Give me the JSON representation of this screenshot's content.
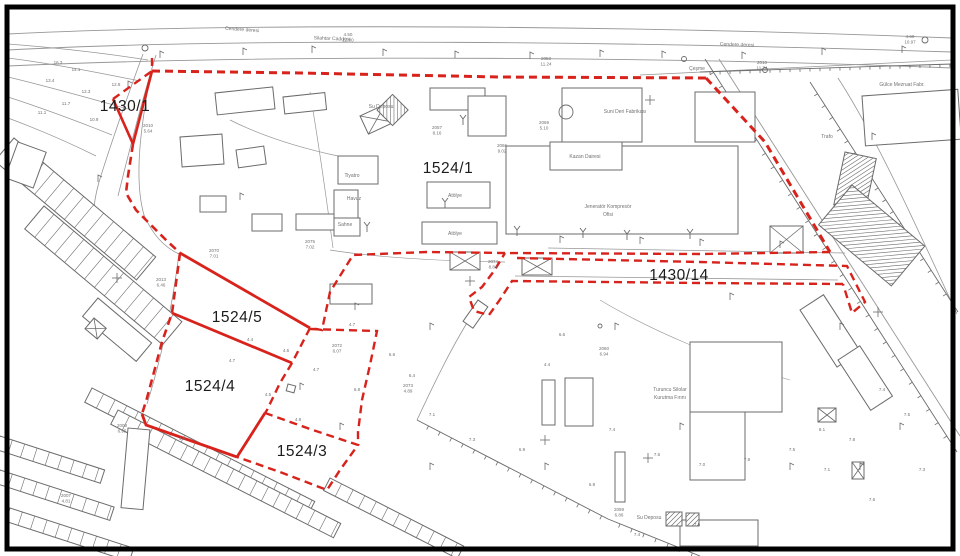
{
  "meta": {
    "type": "cadastral-survey-map",
    "width": 960,
    "height": 556
  },
  "colors": {
    "background": "#ffffff",
    "frame": "#000000",
    "ink": "#6b6b6b",
    "ink_light": "#979797",
    "red": "#d8231c",
    "text_dark": "#1c1c1c",
    "text_gray": "#707070"
  },
  "parcel_labels": [
    {
      "id": "1430/1",
      "x": 125,
      "y": 111
    },
    {
      "id": "1524/1",
      "x": 448,
      "y": 173
    },
    {
      "id": "1430/14",
      "x": 679,
      "y": 280
    },
    {
      "id": "1524/5",
      "x": 237,
      "y": 322
    },
    {
      "id": "1524/4",
      "x": 210,
      "y": 391
    },
    {
      "id": "1524/3",
      "x": 302,
      "y": 456
    }
  ],
  "street_labels": [
    {
      "text": "Cendere deresi",
      "x": 242,
      "y": 31,
      "rot": 4
    },
    {
      "text": "Silahtar Caddesi",
      "x": 332,
      "y": 40,
      "rot": 2
    },
    {
      "text": "Cendere deresi",
      "x": 737,
      "y": 46,
      "rot": 2
    },
    {
      "text": "Çeşme",
      "x": 697,
      "y": 70,
      "rot": 0
    }
  ],
  "facility_labels": [
    {
      "text": "Suni Deri Fabrikası",
      "x": 625,
      "y": 113
    },
    {
      "text": "Kazan Dairesi",
      "x": 585,
      "y": 158
    },
    {
      "text": "Jeneratör Kompresör",
      "x": 608,
      "y": 208
    },
    {
      "text": "Ofisi",
      "x": 608,
      "y": 216
    },
    {
      "text": "Tiyatro",
      "x": 352,
      "y": 177
    },
    {
      "text": "Havuz",
      "x": 354,
      "y": 200
    },
    {
      "text": "Sahne",
      "x": 345,
      "y": 226
    },
    {
      "text": "Atölye",
      "x": 455,
      "y": 197
    },
    {
      "text": "Atölye",
      "x": 455,
      "y": 235
    },
    {
      "text": "Su Deposu",
      "x": 381,
      "y": 108
    },
    {
      "text": "Gülce Mezruat Fabr.",
      "x": 902,
      "y": 86
    },
    {
      "text": "Trafo",
      "x": 827,
      "y": 138
    },
    {
      "text": "Turuncu Silolar",
      "x": 670,
      "y": 391
    },
    {
      "text": "Kurutma Fırını",
      "x": 670,
      "y": 399
    },
    {
      "text": "Su Deposu",
      "x": 649,
      "y": 519
    }
  ],
  "survey_points": [
    {
      "id": "2010",
      "elev": "5.64",
      "x": 148,
      "y": 127
    },
    {
      "id": "2053",
      "elev": "11.24",
      "x": 546,
      "y": 60
    },
    {
      "id": "2010",
      "elev": "11.74",
      "x": 762,
      "y": 64
    },
    {
      "id": "4.50",
      "elev": "12.00",
      "x": 348,
      "y": 36
    },
    {
      "id": "4.60",
      "elev": "10.97",
      "x": 910,
      "y": 38
    },
    {
      "id": "2057",
      "elev": "8.16",
      "x": 437,
      "y": 129
    },
    {
      "id": "2069",
      "elev": "5.10",
      "x": 544,
      "y": 124
    },
    {
      "id": "2066",
      "elev": "9.02",
      "x": 502,
      "y": 147
    },
    {
      "id": "2074",
      "elev": "8.84",
      "x": 493,
      "y": 263
    },
    {
      "id": "2075",
      "elev": "7.02",
      "x": 310,
      "y": 243
    },
    {
      "id": "2070",
      "elev": "7.01",
      "x": 214,
      "y": 252
    },
    {
      "id": "2013",
      "elev": "6.46",
      "x": 161,
      "y": 281
    },
    {
      "id": "2072",
      "elev": "6.07",
      "x": 337,
      "y": 347
    },
    {
      "id": "2073",
      "elev": "4.89",
      "x": 408,
      "y": 387
    },
    {
      "id": "2008",
      "elev": "6.95",
      "x": 122,
      "y": 427
    },
    {
      "id": "2007",
      "elev": "4.81",
      "x": 66,
      "y": 497
    },
    {
      "id": "2059",
      "elev": "6.86",
      "x": 619,
      "y": 511
    },
    {
      "id": "2060",
      "elev": "6.94",
      "x": 604,
      "y": 350
    }
  ],
  "spot_heights": [
    [
      "16.3",
      58,
      64
    ],
    [
      "14.1",
      76,
      71
    ],
    [
      "13.4",
      50,
      82
    ],
    [
      "12.3",
      86,
      93
    ],
    [
      "11.7",
      66,
      105
    ],
    [
      "11.1",
      42,
      114
    ],
    [
      "10.9",
      94,
      121
    ],
    [
      "12.8",
      116,
      86
    ],
    [
      "4.4",
      250,
      341
    ],
    [
      "4.6",
      286,
      352
    ],
    [
      "4.7",
      232,
      362
    ],
    [
      "4.5",
      268,
      396
    ],
    [
      "4.8",
      298,
      421
    ],
    [
      "4.6",
      182,
      440
    ],
    [
      "4.7",
      316,
      371
    ],
    [
      "4.7",
      352,
      326
    ],
    [
      "4.4",
      547,
      366
    ],
    [
      "6.6",
      392,
      356
    ],
    [
      "6.4",
      412,
      377
    ],
    [
      "6.8",
      357,
      391
    ],
    [
      "7.1",
      432,
      416
    ],
    [
      "7.3",
      472,
      441
    ],
    [
      "6.9",
      522,
      451
    ],
    [
      "7.4",
      612,
      431
    ],
    [
      "7.6",
      657,
      456
    ],
    [
      "7.0",
      702,
      466
    ],
    [
      "7.8",
      747,
      461
    ],
    [
      "7.5",
      792,
      451
    ],
    [
      "8.1",
      822,
      431
    ],
    [
      "7.4",
      882,
      391
    ],
    [
      "7.5",
      907,
      416
    ],
    [
      "7.8",
      852,
      441
    ],
    [
      "7.1",
      827,
      471
    ],
    [
      "7.6",
      872,
      501
    ],
    [
      "7.3",
      922,
      471
    ],
    [
      "6.6",
      562,
      336
    ],
    [
      "6.9",
      592,
      486
    ],
    [
      "7.4",
      637,
      536
    ],
    [
      "7.5",
      697,
      526
    ]
  ],
  "red_layer": {
    "solid": [
      {
        "d": "M113,99 L133,144",
        "w": 2.6
      },
      {
        "d": "M133,144 L152,71",
        "w": 2.6
      },
      {
        "d": "M180,253 L310,328",
        "w": 2.8
      },
      {
        "d": "M172,313 L292,363",
        "w": 2.8
      },
      {
        "d": "M265,413 L237,457",
        "w": 2.8
      },
      {
        "d": "M142,414 L146,425 L237,457",
        "w": 2.8
      }
    ],
    "dashed": [
      {
        "d": "M113,99 L152,71",
        "w": 2.4
      },
      {
        "d": "M152,58 L152,70",
        "w": 2.4
      },
      {
        "d": "M152,71 L300,73 L500,77 L706,78",
        "w": 3
      },
      {
        "d": "M706,78 L765,142 L830,252",
        "w": 3
      },
      {
        "d": "M830,252 L700,254 L505,253 L427,252 L353,255 L330,292 L322,330 L310,328",
        "w": 2.4
      },
      {
        "d": "M517,258 L700,262 L847,266 L865,302 L852,313 L843,284",
        "w": 2.4
      },
      {
        "d": "M843,284 L700,283 L512,281 L499,301 L489,315 L474,311 L469,297 L482,287 L494,271 L505,253",
        "w": 2.4
      },
      {
        "d": "M133,144 L128,176 L126,193 L136,210 L148,222 L166,240 L180,253",
        "w": 2.6
      },
      {
        "d": "M180,253 L172,313 L162,342 L154,372 L147,398 L142,414",
        "w": 2.6
      },
      {
        "d": "M310,328 L292,363",
        "w": 2.4
      },
      {
        "d": "M292,363 L280,383 L267,410 L265,413",
        "w": 2.4
      },
      {
        "d": "M265,413 L310,429 L358,445 L340,470 L327,490 L280,472 L237,457",
        "w": 2.4
      },
      {
        "d": "M310,329 L377,331 L370,365 L362,400 L358,432 L358,445",
        "w": 2.4
      }
    ]
  },
  "gray_layer": {
    "paths": [
      {
        "d": "M8,34 C250,22 650,26 952,38",
        "w": 0.9
      },
      {
        "d": "M8,50 C250,37 650,42 952,52",
        "w": 0.9
      },
      {
        "d": "M8,66 C300,53 700,58 952,68",
        "w": 0.9
      },
      {
        "d": "M640,75 C760,70 870,64 952,60",
        "w": 0.8
      },
      {
        "d": "M143,54 C128,95 112,140 99,182 C94,200 92,215 95,228",
        "w": 0.8
      },
      {
        "d": "M156,55 C142,100 130,148 118,196",
        "w": 0.8
      },
      {
        "d": "M8,44 C60,48 110,54 148,60",
        "w": 0.7
      },
      {
        "d": "M8,58 C55,64 100,73 140,81",
        "w": 0.7
      },
      {
        "d": "M8,77 C50,87 92,99 128,109",
        "w": 0.7
      },
      {
        "d": "M8,97 C45,109 82,123 112,135",
        "w": 0.7
      },
      {
        "d": "M8,118 C40,130 70,143 96,156",
        "w": 0.7
      },
      {
        "d": "M151,72 C140,130 134,180 144,215 C154,238 168,249 179,254",
        "w": 0.8
      },
      {
        "d": "M179,254 C173,300 164,350 147,404",
        "w": 0.8
      },
      {
        "d": "M230,120 C270,140 310,150 338,156",
        "w": 0.7
      },
      {
        "d": "M310,92 C318,140 326,195 333,248",
        "w": 0.7
      },
      {
        "d": "M548,248 L845,253",
        "w": 0.8
      },
      {
        "d": "M515,276 L838,280",
        "w": 0.8
      },
      {
        "d": "M470,318 C450,350 432,388 417,420",
        "w": 0.8
      },
      {
        "d": "M719,59 L960,436",
        "w": 0.9
      },
      {
        "d": "M838,78 C878,140 918,230 957,314",
        "w": 0.8
      },
      {
        "d": "M330,250 C380,258 440,261 505,262",
        "w": 0.7
      },
      {
        "d": "M600,300 C650,330 720,360 790,380",
        "w": 0.6
      }
    ],
    "fences": [
      {
        "x1": 705,
        "y1": 59,
        "x2": 957,
        "y2": 452,
        "gap": 16,
        "t": 4
      },
      {
        "x1": 810,
        "y1": 82,
        "x2": 958,
        "y2": 312,
        "gap": 14,
        "t": 4
      },
      {
        "x1": 417,
        "y1": 420,
        "x2": 608,
        "y2": 519,
        "gap": 13,
        "t": 4
      },
      {
        "x1": 608,
        "y1": 519,
        "x2": 700,
        "y2": 556,
        "gap": 13,
        "t": 4
      },
      {
        "x1": 700,
        "y1": 72,
        "x2": 952,
        "y2": 64,
        "gap": 10,
        "t": 3
      }
    ],
    "buildings": [
      [
        215,
        93,
        58,
        22,
        -6,
        0
      ],
      [
        283,
        97,
        42,
        17,
        -6,
        0
      ],
      [
        180,
        137,
        42,
        30,
        -4,
        0
      ],
      [
        236,
        150,
        28,
        18,
        -8,
        0
      ],
      [
        200,
        196,
        26,
        16,
        0,
        0
      ],
      [
        252,
        214,
        30,
        17,
        0,
        0
      ],
      [
        296,
        214,
        38,
        16,
        0,
        0
      ],
      [
        338,
        156,
        40,
        28,
        0,
        0
      ],
      [
        334,
        190,
        24,
        28,
        0,
        0
      ],
      [
        334,
        218,
        26,
        18,
        0,
        0
      ],
      [
        360,
        116,
        28,
        20,
        -25,
        1
      ],
      [
        377,
        110,
        22,
        22,
        -45,
        2
      ],
      [
        427,
        182,
        63,
        26,
        0,
        0
      ],
      [
        422,
        222,
        75,
        22,
        0,
        0
      ],
      [
        430,
        88,
        55,
        22,
        0,
        0
      ],
      [
        450,
        252,
        30,
        18,
        0,
        1
      ],
      [
        522,
        258,
        30,
        17,
        0,
        1
      ],
      [
        770,
        226,
        33,
        27,
        0,
        1
      ],
      [
        506,
        146,
        232,
        88,
        0,
        0
      ],
      [
        562,
        88,
        80,
        54,
        0,
        0
      ],
      [
        468,
        96,
        38,
        40,
        0,
        0
      ],
      [
        550,
        142,
        72,
        28,
        0,
        0
      ],
      [
        695,
        92,
        60,
        50,
        0,
        0
      ],
      [
        862,
        96,
        96,
        50,
        -4,
        0
      ],
      [
        845,
        152,
        32,
        54,
        12,
        2
      ],
      [
        852,
        185,
        95,
        52,
        40,
        2
      ],
      [
        690,
        342,
        92,
        70,
        0,
        0
      ],
      [
        690,
        412,
        55,
        68,
        0,
        0
      ],
      [
        800,
        310,
        28,
        68,
        -33,
        0
      ],
      [
        838,
        360,
        26,
        60,
        -33,
        0
      ],
      [
        542,
        380,
        13,
        45,
        0,
        0
      ],
      [
        565,
        378,
        28,
        48,
        0,
        0
      ],
      [
        615,
        452,
        10,
        50,
        0,
        0
      ],
      [
        680,
        520,
        78,
        26,
        0,
        0
      ],
      [
        666,
        512,
        16,
        14,
        0,
        2
      ],
      [
        686,
        513,
        13,
        13,
        0,
        2
      ],
      [
        818,
        408,
        18,
        14,
        0,
        1
      ],
      [
        852,
        462,
        12,
        17,
        0,
        1
      ],
      [
        14,
        138,
        185,
        30,
        40,
        3
      ],
      [
        44,
        206,
        180,
        30,
        40,
        3
      ],
      [
        98,
        298,
        70,
        24,
        40,
        0
      ],
      [
        92,
        388,
        250,
        16,
        27,
        3
      ],
      [
        118,
        410,
        250,
        16,
        27,
        3
      ],
      [
        330,
        478,
        150,
        14,
        27,
        3
      ],
      [
        0,
        436,
        110,
        14,
        18,
        3
      ],
      [
        0,
        470,
        120,
        14,
        18,
        3
      ],
      [
        10,
        508,
        130,
        14,
        18,
        3
      ],
      [
        128,
        428,
        22,
        80,
        5,
        0
      ],
      [
        478,
        300,
        12,
        26,
        35,
        0
      ],
      [
        18,
        142,
        30,
        38,
        20,
        0
      ],
      [
        288,
        384,
        8,
        7,
        15,
        0
      ],
      [
        330,
        284,
        42,
        20,
        0,
        0
      ],
      [
        94,
        318,
        16,
        14,
        40,
        1
      ]
    ],
    "circles": [
      [
        145,
        48,
        3
      ],
      [
        765,
        70,
        2.5
      ],
      [
        925,
        40,
        3
      ],
      [
        566,
        112,
        7
      ],
      [
        600,
        326,
        2
      ],
      [
        684,
        59,
        2.5
      ]
    ],
    "crosses": [
      [
        470,
        281
      ],
      [
        650,
        100
      ],
      [
        648,
        458
      ],
      [
        117,
        278
      ],
      [
        545,
        440
      ],
      [
        878,
        312
      ]
    ],
    "poles": [
      [
        445,
        208
      ],
      [
        517,
        236
      ],
      [
        583,
        238
      ],
      [
        627,
        240
      ],
      [
        690,
        239
      ],
      [
        367,
        232
      ],
      [
        463,
        125
      ]
    ],
    "flags": [
      [
        160,
        58
      ],
      [
        243,
        55
      ],
      [
        312,
        53
      ],
      [
        383,
        56
      ],
      [
        455,
        58
      ],
      [
        530,
        59
      ],
      [
        600,
        57
      ],
      [
        662,
        58
      ],
      [
        742,
        59
      ],
      [
        822,
        55
      ],
      [
        902,
        53
      ],
      [
        560,
        243
      ],
      [
        640,
        244
      ],
      [
        700,
        246
      ],
      [
        780,
        248
      ],
      [
        240,
        200
      ],
      [
        355,
        310
      ],
      [
        300,
        390
      ],
      [
        340,
        430
      ],
      [
        430,
        330
      ],
      [
        615,
        330
      ],
      [
        680,
        430
      ],
      [
        730,
        300
      ],
      [
        840,
        330
      ],
      [
        790,
        470
      ],
      [
        860,
        470
      ],
      [
        900,
        430
      ],
      [
        545,
        470
      ],
      [
        430,
        470
      ],
      [
        98,
        182
      ],
      [
        128,
        88
      ],
      [
        872,
        140
      ]
    ]
  }
}
